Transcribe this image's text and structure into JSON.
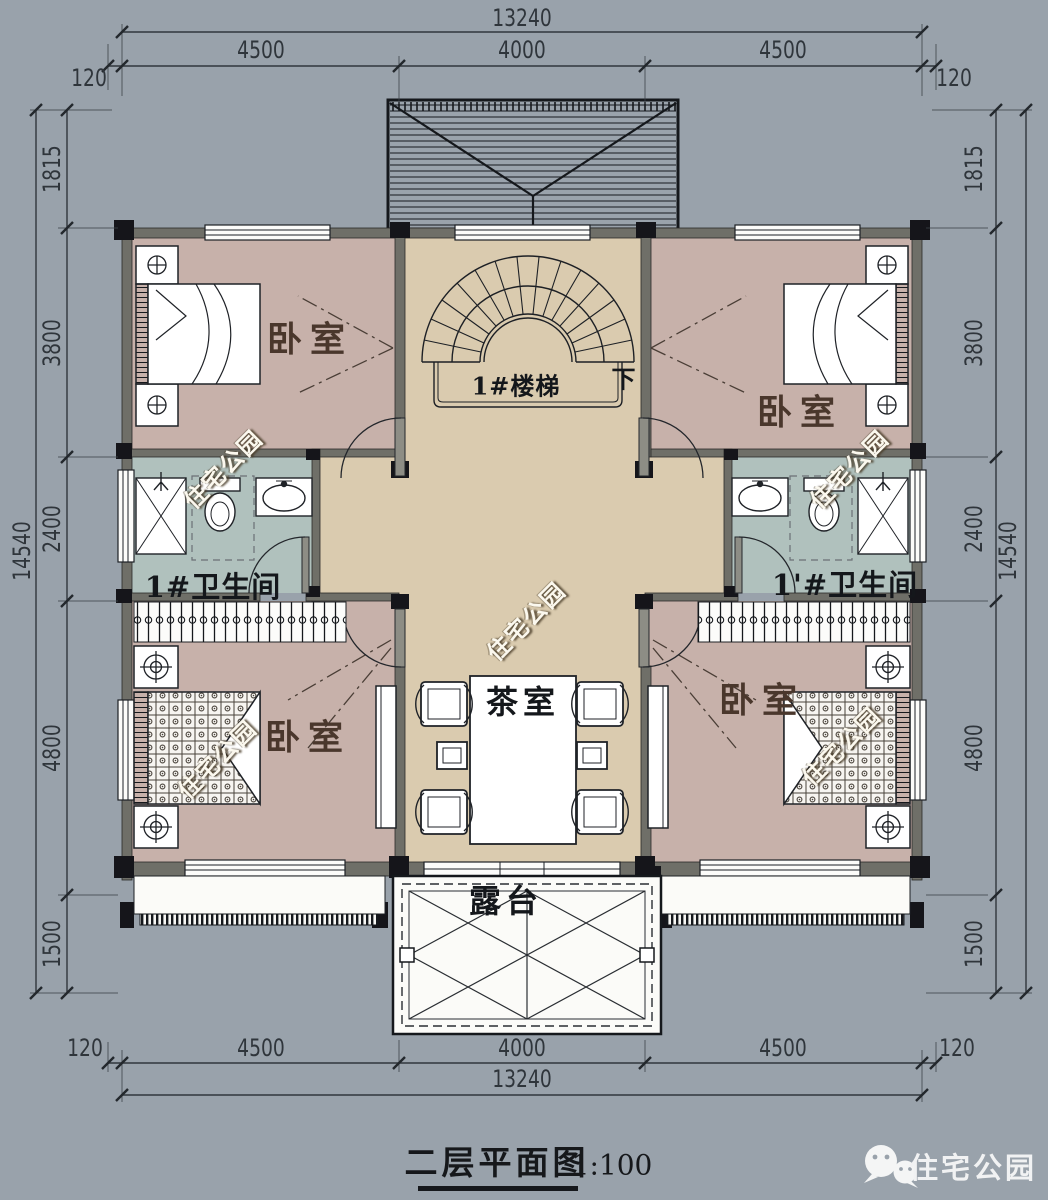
{
  "title_block": {
    "title": "二层平面图",
    "scale": "1:100"
  },
  "brand": {
    "name": "住宅公园",
    "icon": "wechat-icon"
  },
  "watermark": {
    "text": "住宅公园"
  },
  "rooms": {
    "bedroom_top_left": "卧室",
    "bedroom_top_right": "卧室",
    "bedroom_bottom_left": "卧室",
    "bedroom_bottom_right": "卧室",
    "bathroom_left": "1#卫生间",
    "bathroom_right": "1'#卫生间",
    "tea_room": "茶室",
    "terrace": "露台",
    "stairs": "1#楼梯",
    "stairs_down": "下"
  },
  "dims": {
    "top": {
      "overall": "13240",
      "segs": [
        "4500",
        "4000",
        "4500"
      ],
      "left_offset": "120",
      "right_offset": "120"
    },
    "bottom": {
      "overall": "13240",
      "segs": [
        "4500",
        "4000",
        "4500"
      ],
      "left_offset": "120",
      "right_offset": "120"
    },
    "left": {
      "overall": "14540",
      "segs": [
        "1815",
        "3800",
        "2400",
        "4800",
        "1500"
      ]
    },
    "right": {
      "overall": "14540",
      "segs": [
        "1815",
        "3800",
        "2400",
        "4800",
        "1500"
      ]
    }
  },
  "colors": {
    "background": "#99a2ab",
    "wall": "#6f6f68",
    "bedroom_floor": "#c7b1aa",
    "hall_floor": "#dacbaf",
    "bath_floor": "#b0c1bd",
    "drawing_line": "#23262b"
  }
}
